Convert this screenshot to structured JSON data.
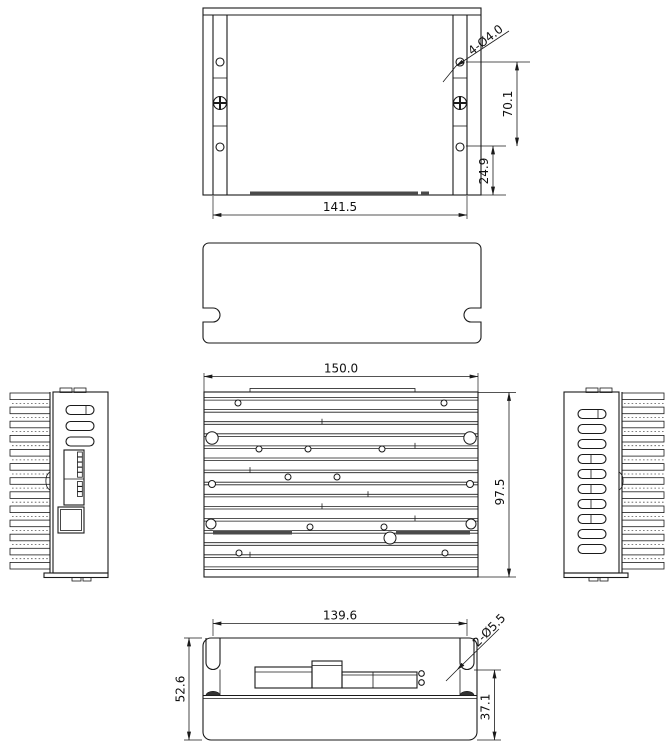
{
  "page": {
    "background": "#ffffff"
  },
  "drawing": {
    "type": "mechanical-orthographic-views",
    "subject": "motor-driver-enclosure",
    "line_color": "#1a1a1a",
    "dark_fill": "#4a4a4a",
    "dimensions": {
      "top_view": {
        "width": "141.5",
        "hole_span_height": "70.1",
        "hole_edge_offset": "24.9",
        "mount_holes": "4-Ø4.0"
      },
      "front_view": {
        "width": "150.0",
        "height": "97.5"
      },
      "bottom_view": {
        "width": "139.6",
        "overall_height": "52.6",
        "body_height": "37.1",
        "slot_holes": "2-Ø5.5"
      }
    }
  }
}
